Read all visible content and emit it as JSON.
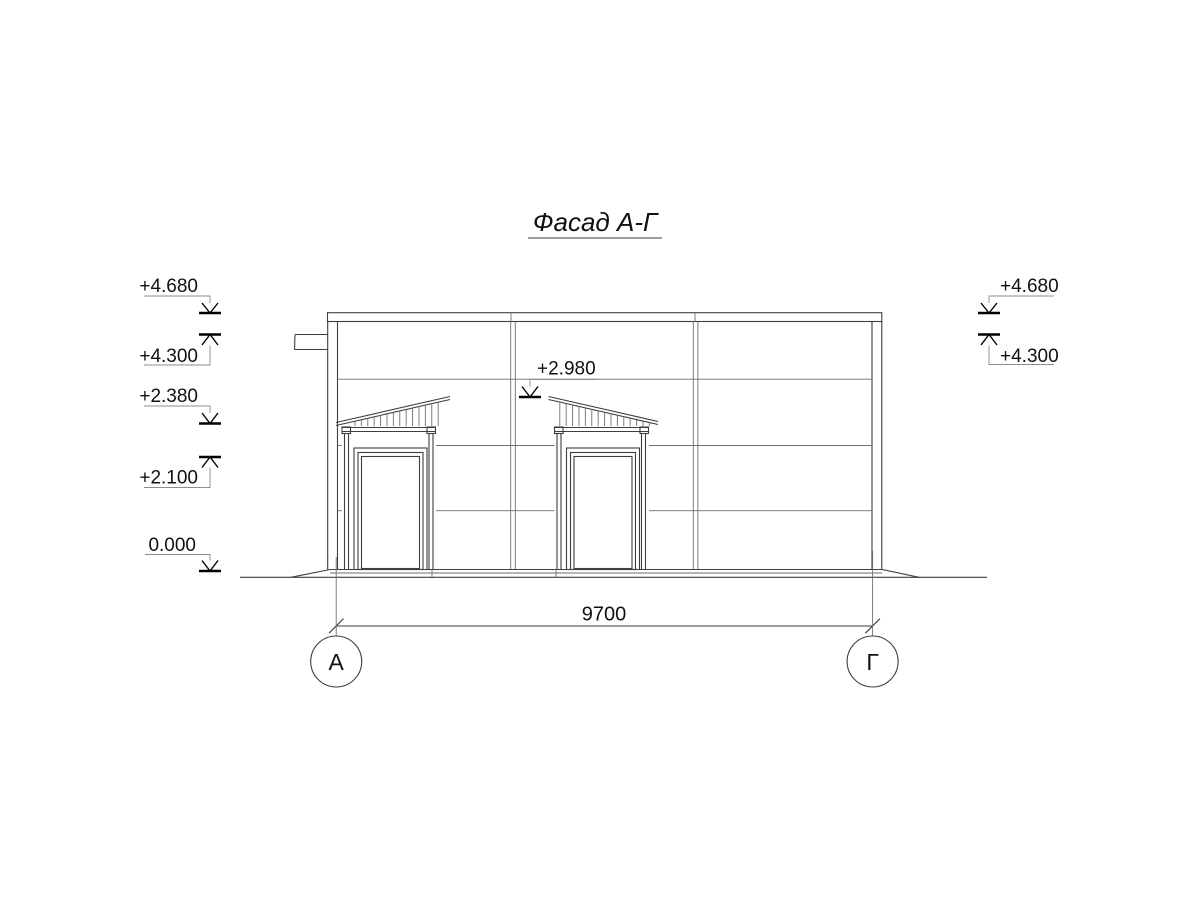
{
  "title": "Фасад А-Г",
  "marks": {
    "left": [
      {
        "label": "+4.680"
      },
      {
        "label": "+4.300"
      },
      {
        "label": "+2.380"
      },
      {
        "label": "+2.100"
      },
      {
        "label": "0.000"
      }
    ],
    "right": [
      {
        "label": "+4.680"
      },
      {
        "label": "+4.300"
      }
    ],
    "center": [
      {
        "label": "+2.980"
      }
    ]
  },
  "dimension": {
    "length": "9700"
  },
  "axes": {
    "left_label": "А",
    "right_label": "Г"
  },
  "colors": {
    "line": "#3e3e3e",
    "text": "#111111",
    "background": "#ffffff"
  }
}
